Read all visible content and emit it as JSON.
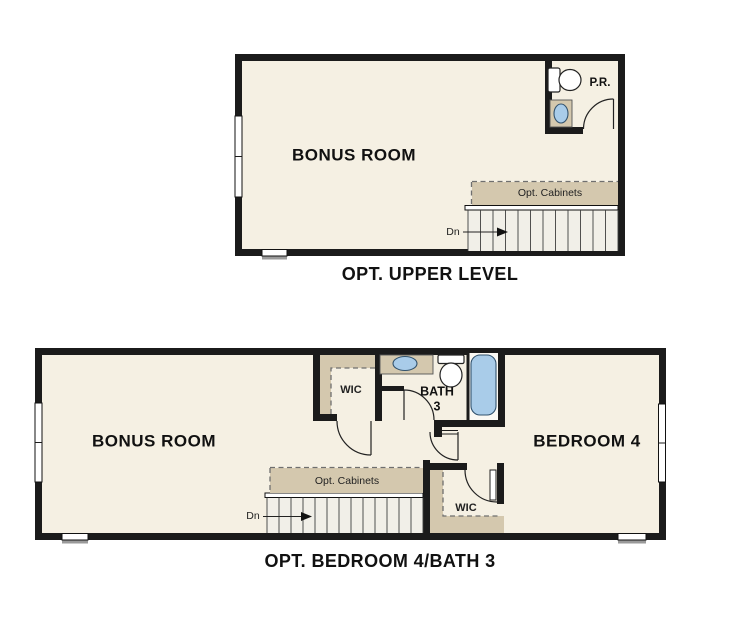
{
  "colors": {
    "page_background": "#ffffff",
    "floor": "#f5f0e3",
    "wall": "#1b1b1b",
    "cabinet_tan": "#d4c8ae",
    "fixture_blue": "#a9cce9",
    "stair_floor": "#f1efe8"
  },
  "upper_plan": {
    "title": "OPT. UPPER LEVEL",
    "bonus_room": "BONUS ROOM",
    "powder_room": "P.R.",
    "cabinets": "Opt. Cabinets",
    "stairs_direction": "Dn"
  },
  "lower_plan": {
    "title": "OPT. BEDROOM 4/BATH 3",
    "bonus_room": "BONUS ROOM",
    "bedroom": "BEDROOM 4",
    "bath_line1": "BATH",
    "bath_line2": "3",
    "wic_upper": "WIC",
    "wic_lower": "WIC",
    "cabinets": "Opt. Cabinets",
    "stairs_direction": "Dn"
  }
}
